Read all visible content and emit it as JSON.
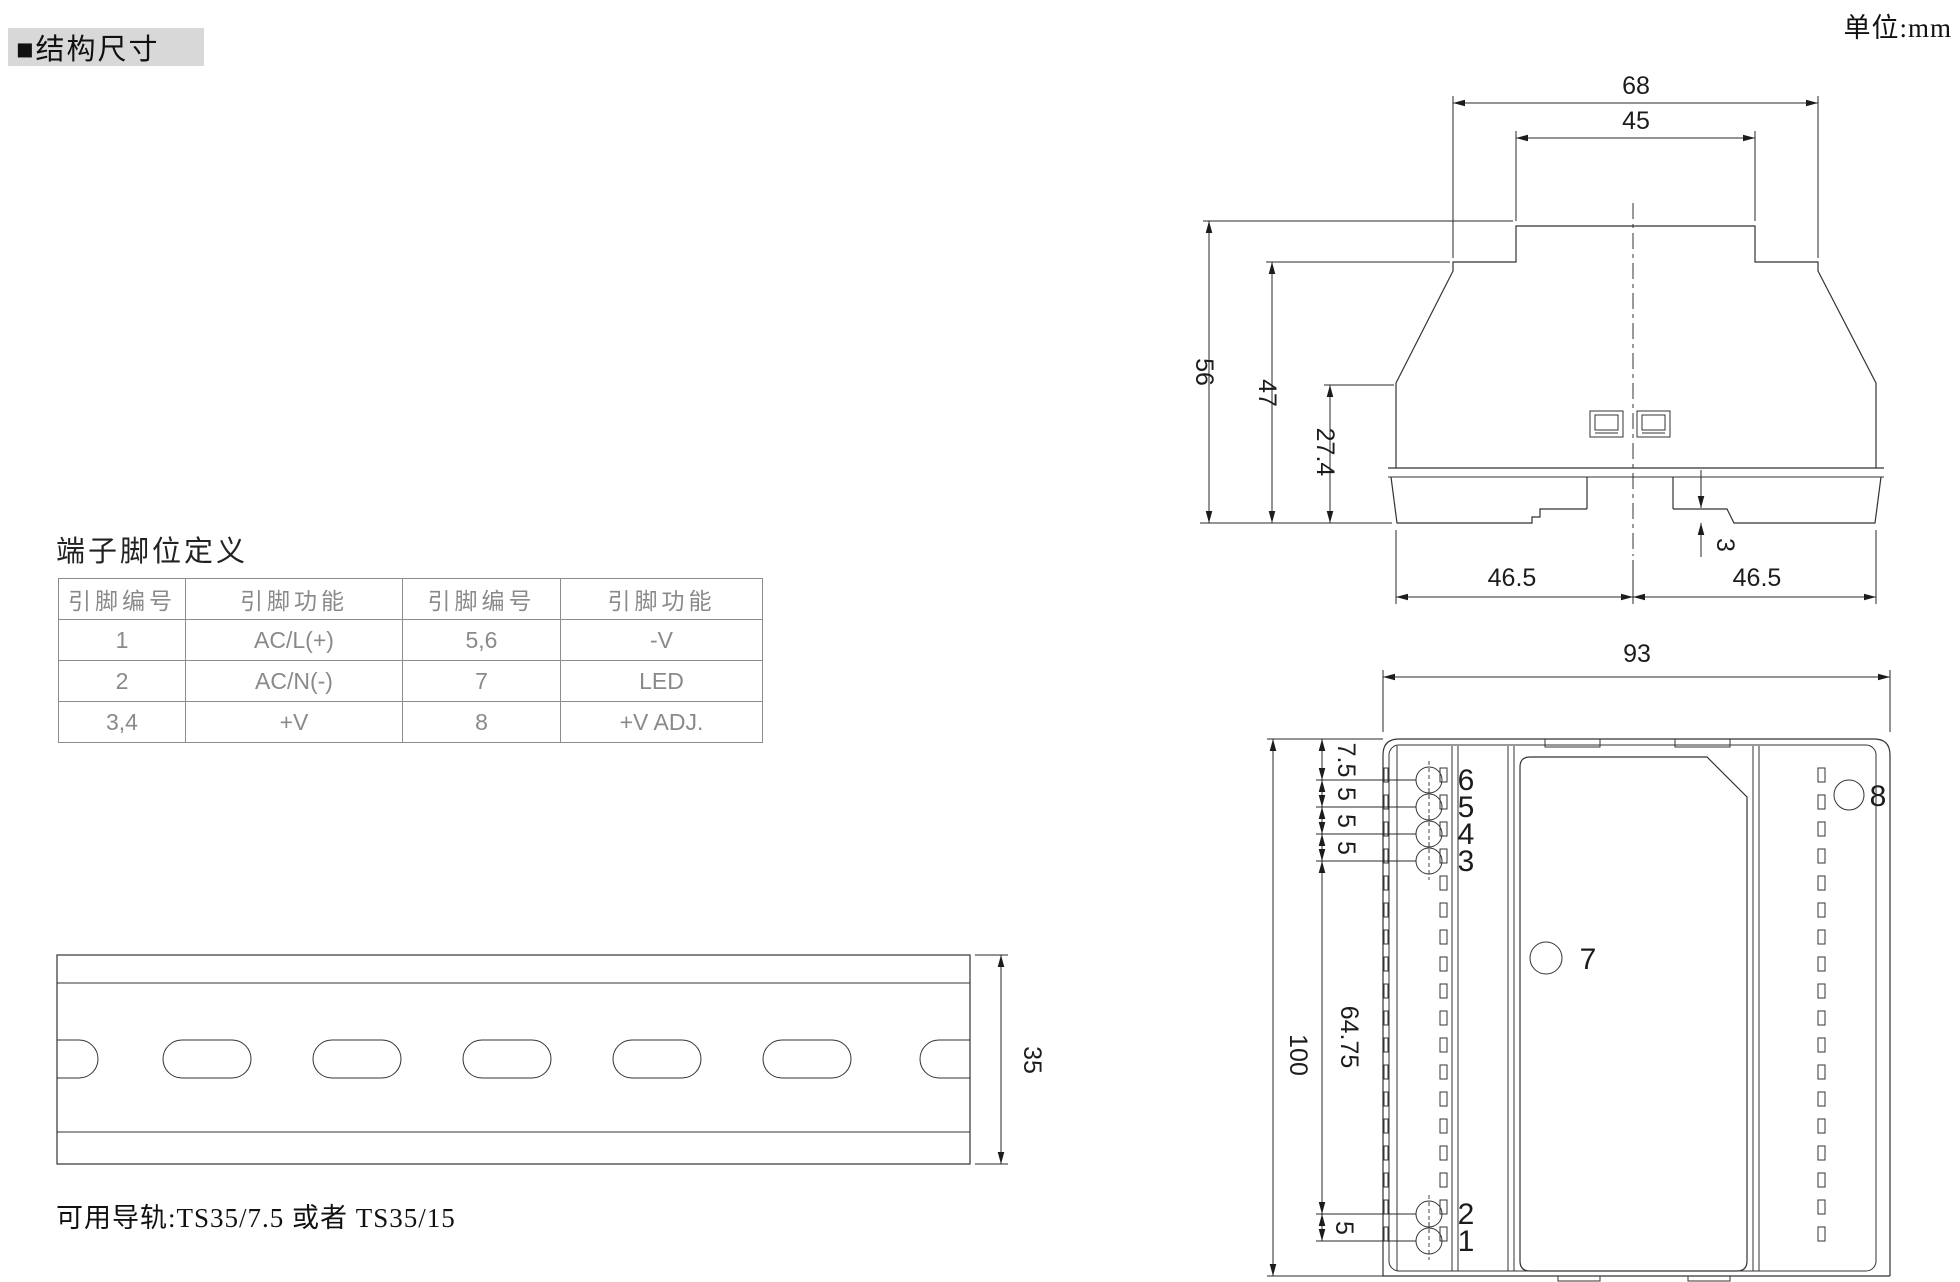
{
  "page": {
    "section_title": "■结构尺寸",
    "unit_label": "单位:mm"
  },
  "pin_table": {
    "title": "端子脚位定义",
    "headers": [
      "引脚编号",
      "引脚功能",
      "引脚编号",
      "引脚功能"
    ],
    "rows": [
      [
        "1",
        "AC/L(+)",
        "5,6",
        "-V"
      ],
      [
        "2",
        "AC/N(-)",
        "7",
        "LED"
      ],
      [
        "3,4",
        "+V",
        "8",
        "+V ADJ."
      ]
    ]
  },
  "top_view": {
    "dims": {
      "outer_width": "68",
      "top_width": "45",
      "total_height": "56",
      "body_height": "47",
      "lower_height": "27.4",
      "base_left": "46.5",
      "base_right": "46.5",
      "clip_depth": "3"
    }
  },
  "front_view": {
    "dims": {
      "width": "93",
      "height": "100",
      "pin_offset_top": "7.5",
      "pin_pitch_1": "5",
      "pin_pitch_2": "5",
      "pin_pitch_3": "5",
      "pin_span_mid": "64.75",
      "pin_pitch_bottom": "5"
    },
    "pin_labels": {
      "p6": "6",
      "p5": "5",
      "p4": "4",
      "p3": "3",
      "p2": "2",
      "p1": "1",
      "led": "7",
      "adj": "8"
    }
  },
  "rail": {
    "dim_height": "35",
    "caption": "可用导轨:TS35/7.5 或者 TS35/15"
  }
}
